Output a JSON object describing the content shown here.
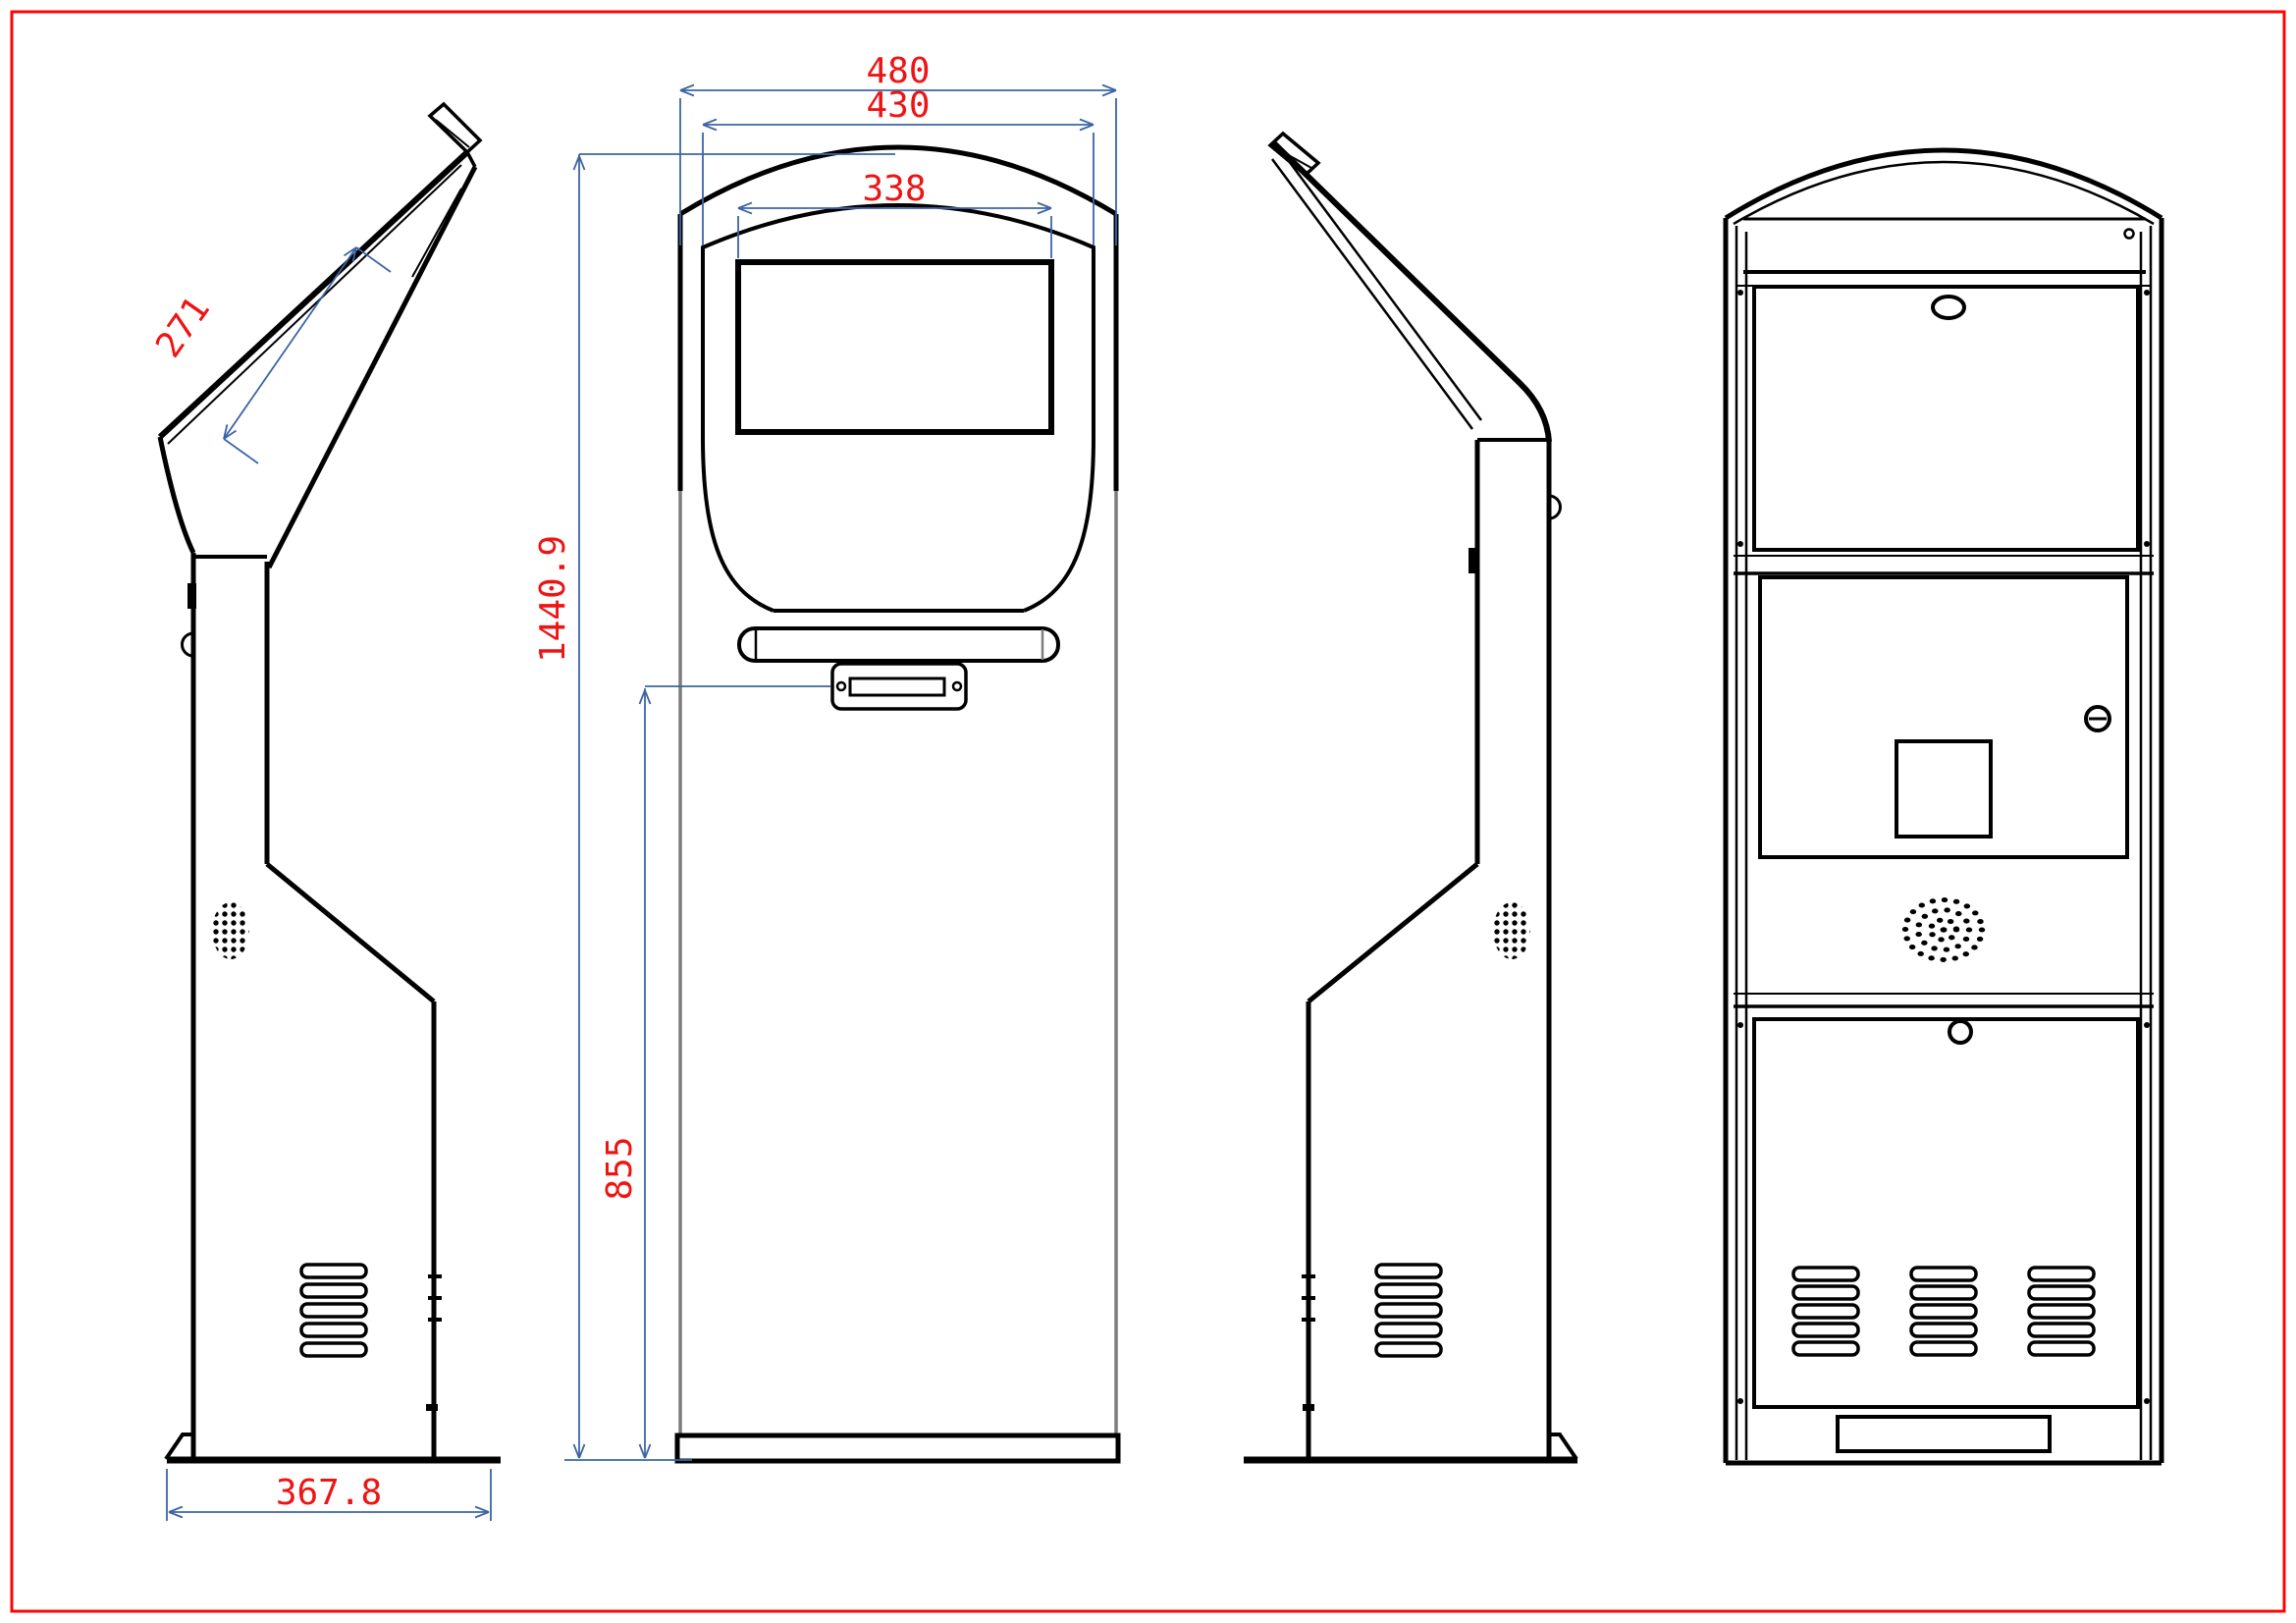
{
  "title": "kiosk-engineering-drawing",
  "colors": {
    "page_border": "#fe0404",
    "outline": "#000000",
    "dimension_line": "#3c64a5",
    "dimension_text": "#ee1414",
    "secondary_line": "#7d7d7d"
  },
  "views": {
    "left_side": {
      "dimensions": {
        "screen_panel_length": "271",
        "base_depth": "367.8"
      }
    },
    "front": {
      "dimensions": {
        "head_width": "480",
        "body_width": "430",
        "screen_width": "338",
        "total_height": "1440.9",
        "card_reader_height": "855"
      }
    },
    "right_side": {
      "dimensions": {}
    },
    "rear": {
      "dimensions": {}
    }
  }
}
